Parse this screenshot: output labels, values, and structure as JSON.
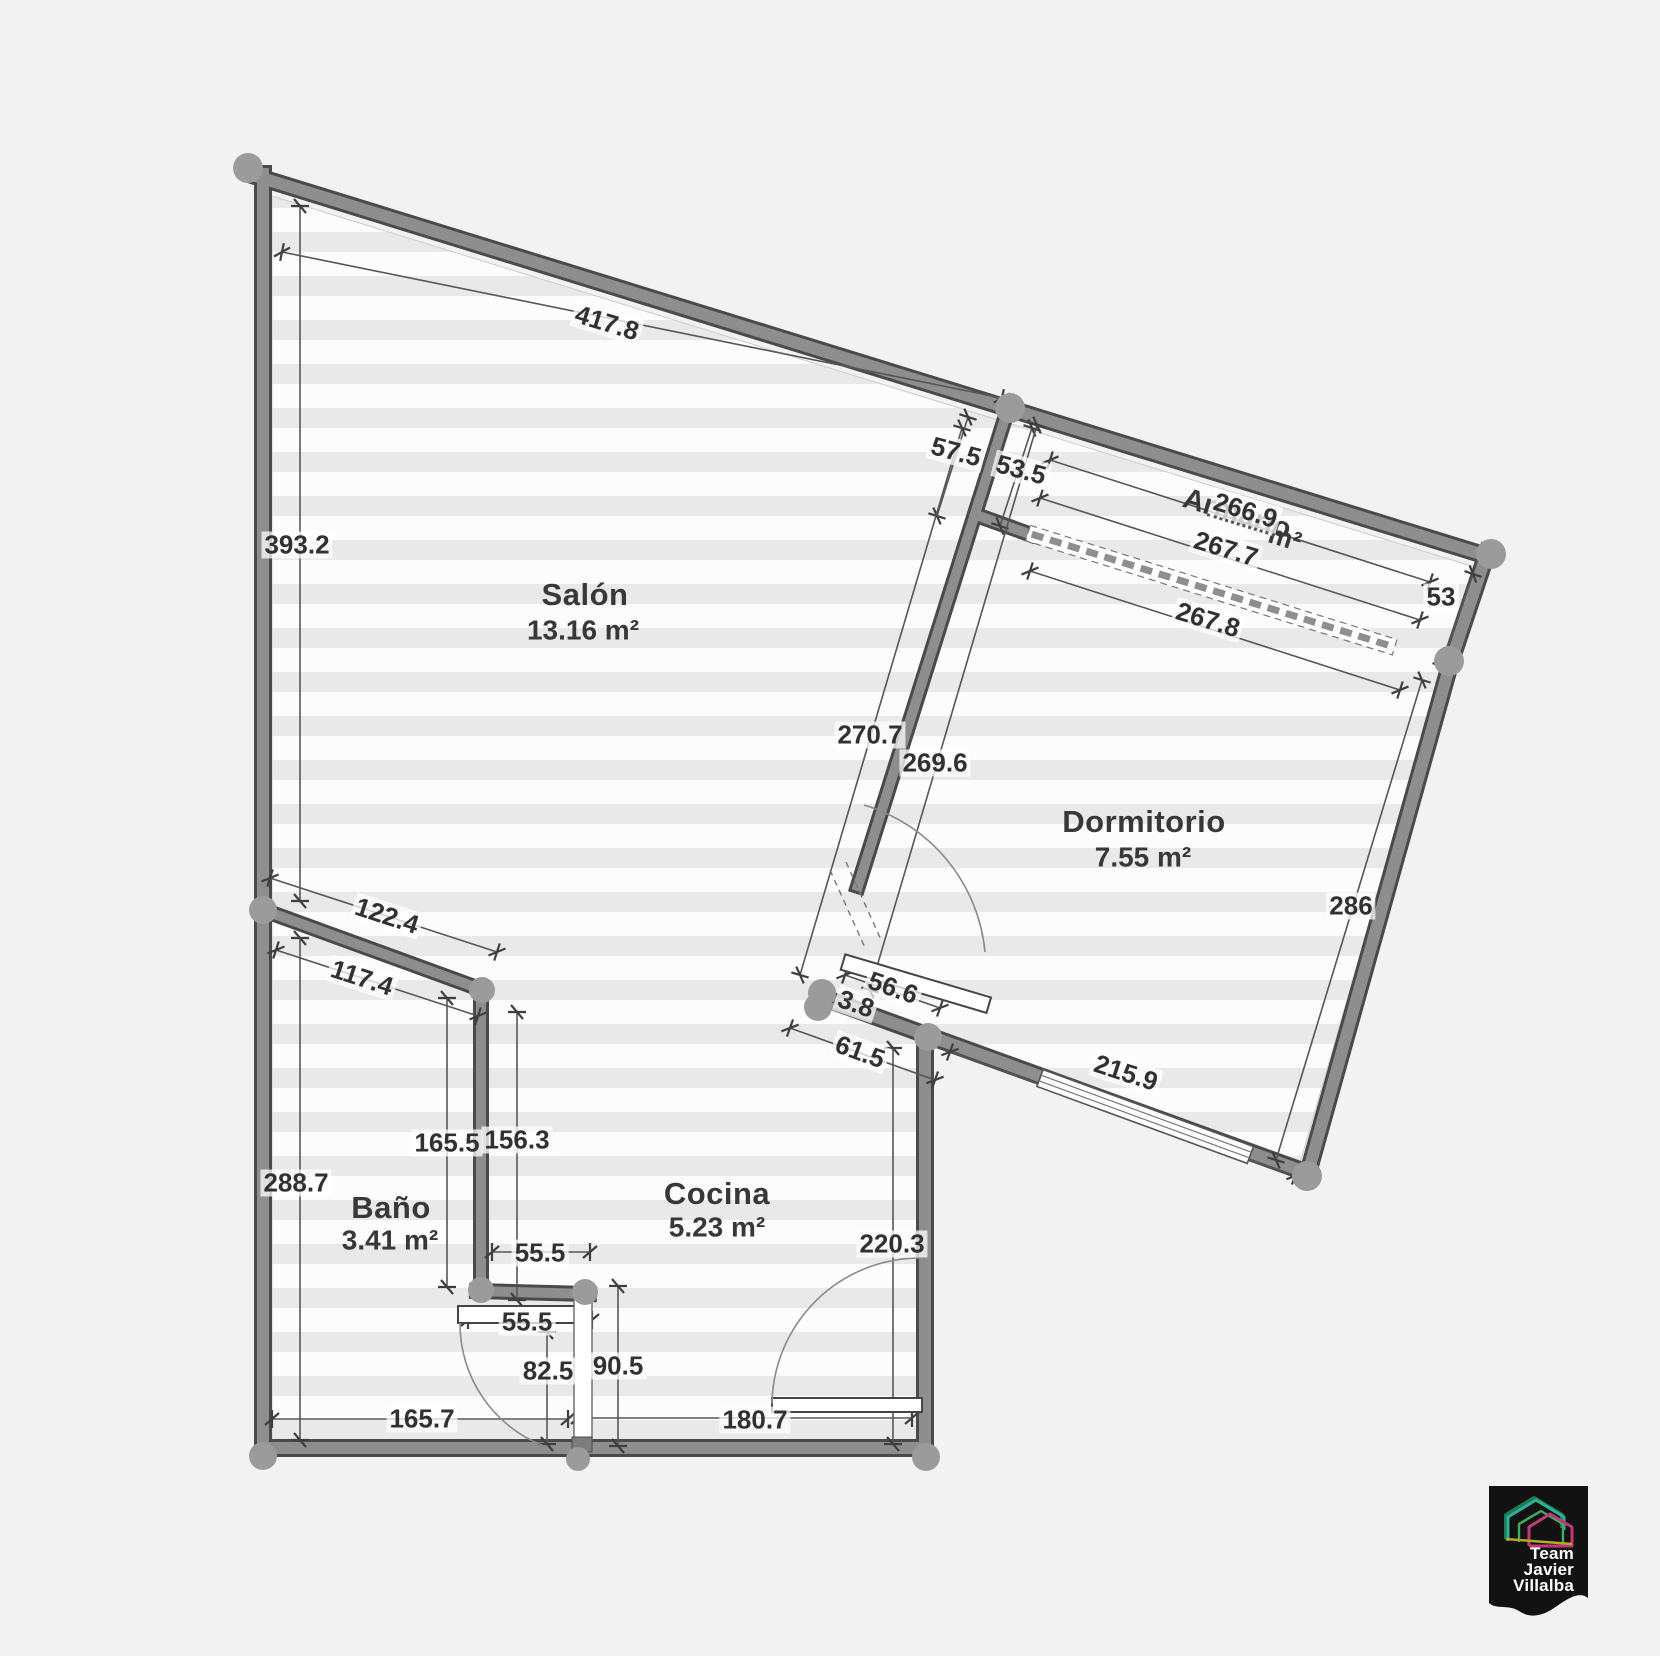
{
  "rooms": {
    "salon": {
      "name": "Salón",
      "area": "13.16 m²"
    },
    "dormitorio": {
      "name": "Dormitorio",
      "area": "7.55 m²"
    },
    "bano": {
      "name": "Baño",
      "area": "3.41 m²"
    },
    "cocina": {
      "name": "Cocina",
      "area": "5.23 m²"
    },
    "armario": {
      "name": "Armario",
      "area_suffix": "m²"
    }
  },
  "dimensions": {
    "top_wall": "417.8",
    "left_upper": "393.2",
    "left_lower": "288.7",
    "divider_top_a": "57.5",
    "divider_top_b": "53.5",
    "armario_len_a": "266.9",
    "armario_len_b": "267.7",
    "armario_len_c": "267.8",
    "armario_end": "53",
    "divider_salon_side": "270.7",
    "divider_dorm_side": "269.6",
    "dorm_right": "286",
    "bano_top_a": "122.4",
    "bano_top_b": "117.4",
    "dorm_door": "56.6",
    "dorm_door_gap": "3.8",
    "dorm_bottom_a": "61.5",
    "dorm_bottom_b": "215.9",
    "bano_height": "165.5",
    "cocina_left_height": "156.3",
    "stub_width": "55.5",
    "bano_door_width": "55.5",
    "bano_door_drop": "82.5",
    "cocina_pass": "90.5",
    "bottom_left": "165.7",
    "bottom_right": "180.7",
    "cocina_height": "220.3"
  },
  "logo": {
    "line1": "Team",
    "line2": "Javier",
    "line3": "Villalba"
  },
  "colors": {
    "background": "#f2f2f2",
    "wall_fill": "#8e8e8e",
    "wall_edge": "#4a4a4a",
    "node": "#9b9b9b",
    "stripe": "#e9e9e9",
    "dim_text": "#313131",
    "logo_house_teal": "#2fae9e",
    "logo_house_magenta": "#c03878",
    "logo_bg": "#121212"
  }
}
